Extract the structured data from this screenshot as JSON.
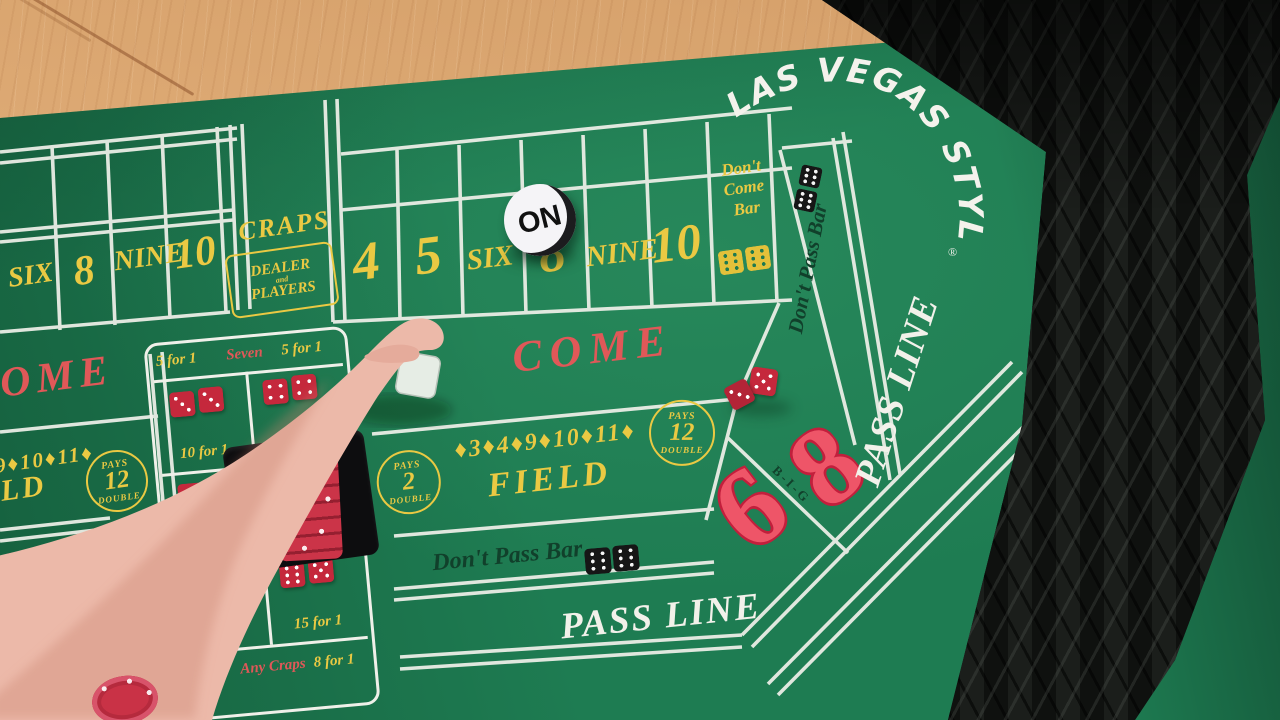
{
  "branding": {
    "logo": "LAS VEGAS STYLE",
    "registered": "®"
  },
  "puck": {
    "label": "ON",
    "face_color": "#f5f4f7",
    "edge_color": "#1c1c1e"
  },
  "table_colors": {
    "felt_green": "#1e7c52",
    "line_white": "#eff0e9",
    "marking_yellow": "#eac943",
    "marking_red": "#e05858",
    "big68_red": "#ee5568",
    "dark_green_text": "#11402b"
  },
  "center_section": {
    "point_boxes": [
      "4",
      "5",
      "SIX",
      "8",
      "NINE",
      "10"
    ],
    "dont_come": {
      "line1": "Don't",
      "line2": "Come",
      "line3": "Bar",
      "dice": [
        6,
        6
      ]
    },
    "come_label": "COME",
    "field": {
      "pays_top": "PAYS",
      "pays_left_num": "2",
      "pays_bottom": "DOUBLE",
      "numbers": "♦3♦4♦9♦10♦11♦",
      "label": "FIELD",
      "pays_right_num": "12"
    },
    "dont_pass": {
      "label": "Don't Pass Bar",
      "dice": [
        6,
        6
      ]
    },
    "pass_line": "PASS LINE"
  },
  "left_section": {
    "point_boxes": [
      "SIX",
      "8",
      "NINE",
      "10"
    ],
    "craps_label": "CRAPS",
    "dealer_box": {
      "line1": "DEALER",
      "line2": "and",
      "line3": "PLAYERS"
    },
    "come_label": "COME",
    "field": {
      "numbers": "♦9♦10♦11♦",
      "label": "FIELD",
      "pays_num": "12"
    },
    "dont_pass_label": "Don't Pass Bar"
  },
  "right_section": {
    "dont_pass": {
      "label": "Don't Pass Bar",
      "dice": [
        6,
        6
      ]
    },
    "pass_line": "PASS LINE",
    "big_six_eight": {
      "six": "6",
      "eight": "8",
      "big": "B-I-G"
    }
  },
  "proposition": {
    "seven_row": {
      "left": "5 for 1",
      "center": "Seven",
      "right": "5 for 1"
    },
    "rows": [
      {
        "left_dice": [
          3,
          3
        ],
        "left_label": "10 for 1",
        "right_dice": [
          4,
          4
        ],
        "right_label": "10 for 1"
      },
      {
        "left_dice": [
          1,
          1
        ],
        "left_label": "30 for 1",
        "right_dice": [
          6,
          6
        ],
        "right_label": "30 for 1"
      },
      {
        "left_dice": [
          6,
          5
        ],
        "left_label": "15 for 1",
        "right_dice": [
          6,
          5
        ],
        "right_label": "15 for 1"
      }
    ],
    "bottom_row": {
      "left": "8 for 1",
      "center": "Any Craps",
      "right": "8 for 1"
    }
  },
  "objects": {
    "thrown_dice": [
      5,
      3
    ],
    "chip_stack_color": "#cb3448",
    "held_piece": "clear die"
  }
}
